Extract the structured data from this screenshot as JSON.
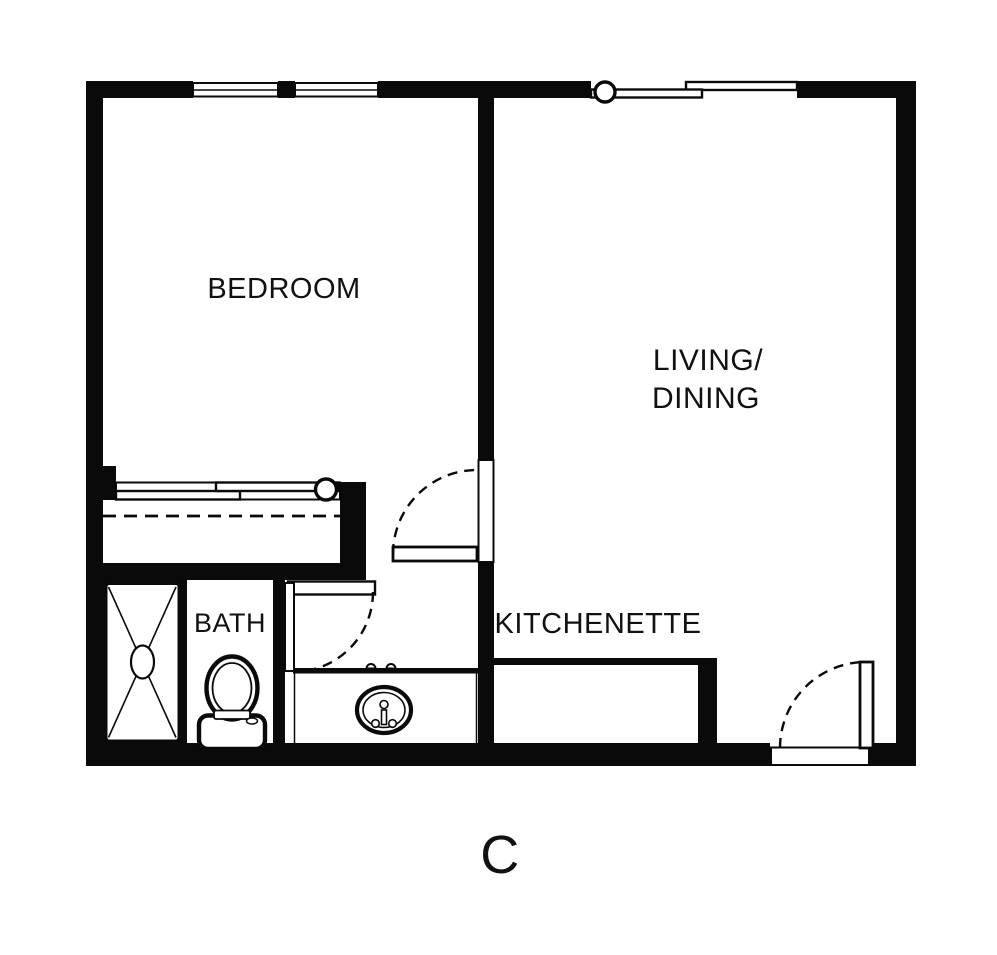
{
  "colors": {
    "wall": "#0a0a0a",
    "background": "#ffffff",
    "floor": "#ffffff",
    "text": "#111111"
  },
  "unit": {
    "label": "C"
  },
  "rooms": {
    "bedroom": {
      "label": "BEDROOM"
    },
    "living_dining": {
      "line1": "LIVING/",
      "line2": "DINING"
    },
    "bath": {
      "label": "BATH"
    },
    "kitchenette": {
      "label": "KITCHENETTE"
    }
  },
  "fixtures": [
    "shower-stall",
    "toilet",
    "vanity-sink",
    "closet-sliding-door",
    "patio-sliding-door",
    "kitchenette-counter",
    "bedroom-windows",
    "entry-door",
    "bedroom-door",
    "bath-door",
    "closet-rod"
  ]
}
